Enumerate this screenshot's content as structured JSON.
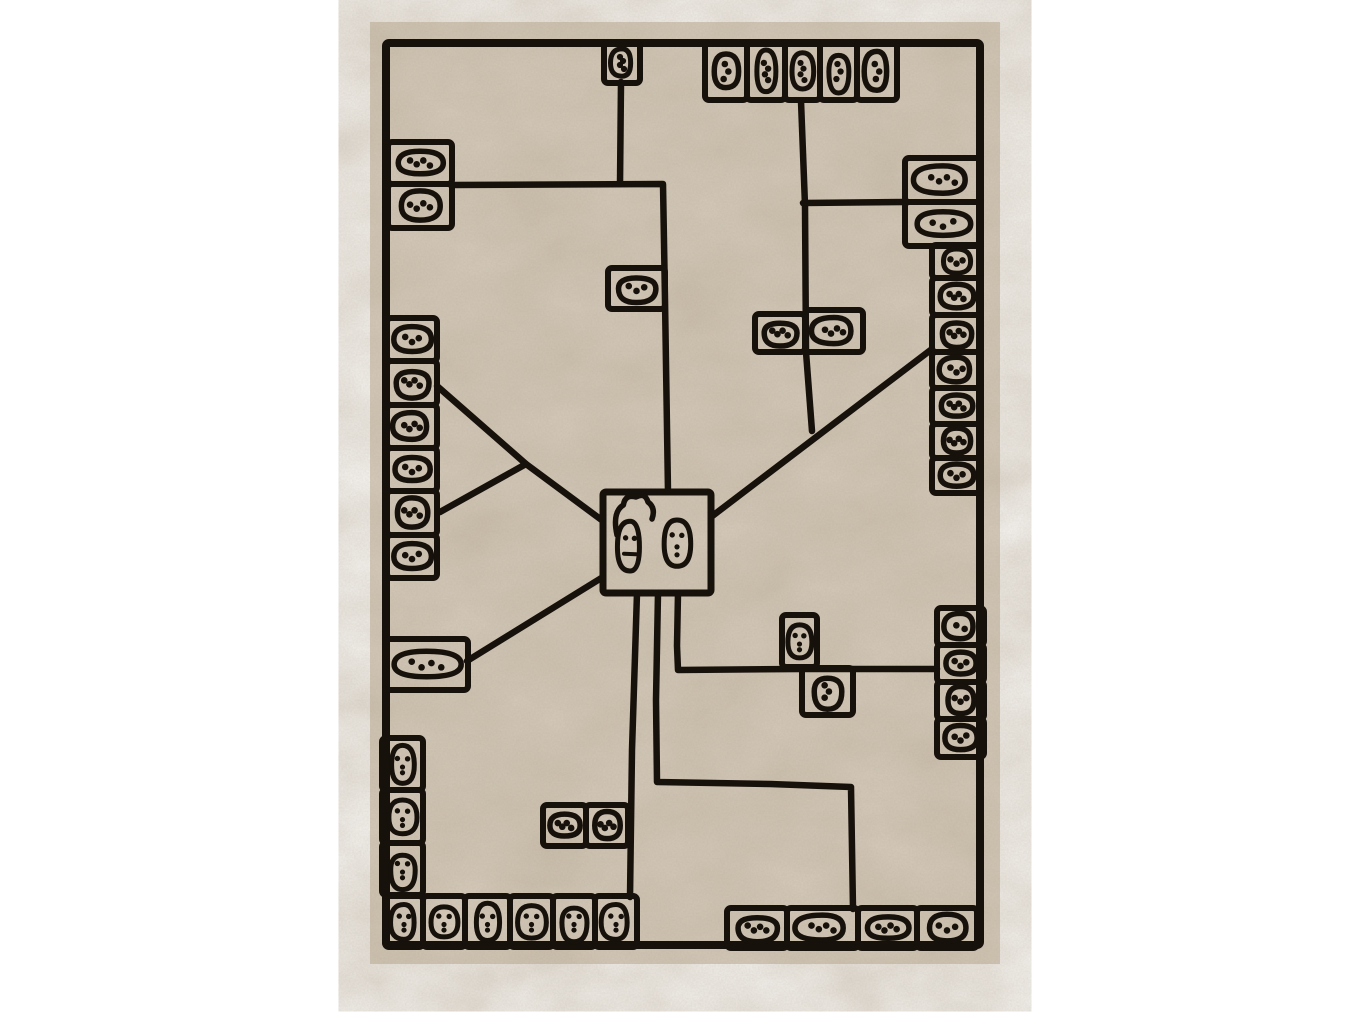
{
  "image": {
    "description": "Cream rectangular area rug with a black hand-drawn abstract line pattern of connected cells containing pebble and face motifs, photographed flat on a white background",
    "width": 1365,
    "height": 1023
  },
  "colors": {
    "page_bg": "#ffffff",
    "rug_base": "#dbd1c3",
    "rug_mottle": "#b3a48e",
    "rug_grain": "#9c8d78",
    "ink": "#17110b"
  },
  "rug": {
    "x": 370,
    "y": 22,
    "width": 630,
    "height": 942
  },
  "border": {
    "x": 386,
    "y": 43,
    "width": 594,
    "height": 902
  },
  "lines": [
    {
      "name": "top-cell-stem",
      "pts": [
        [
          621,
          82
        ],
        [
          620,
          184
        ]
      ]
    },
    {
      "name": "upper-middle-elbow",
      "pts": [
        [
          452,
          185
        ],
        [
          663,
          184
        ],
        [
          665,
          300
        ],
        [
          668,
          492
        ]
      ]
    },
    {
      "name": "left-diagonal-upper",
      "pts": [
        [
          437,
          386
        ],
        [
          526,
          464
        ],
        [
          603,
          521
        ]
      ]
    },
    {
      "name": "left-diagonal-lower",
      "pts": [
        [
          440,
          512
        ],
        [
          526,
          464
        ]
      ]
    },
    {
      "name": "lower-left-diagonal",
      "pts": [
        [
          467,
          661
        ],
        [
          603,
          577
        ]
      ]
    },
    {
      "name": "right-diagonal",
      "pts": [
        [
          711,
          517
        ],
        [
          932,
          349
        ]
      ]
    },
    {
      "name": "upper-right-vertical",
      "pts": [
        [
          801,
          101
        ],
        [
          805,
          205
        ],
        [
          806,
          352
        ],
        [
          812,
          431
        ]
      ]
    },
    {
      "name": "upper-right-branch",
      "pts": [
        [
          803,
          203
        ],
        [
          905,
          202
        ]
      ]
    },
    {
      "name": "center-stem-left",
      "pts": [
        [
          637,
          593
        ],
        [
          632,
          750
        ],
        [
          630,
          897
        ]
      ]
    },
    {
      "name": "center-stem-middle",
      "pts": [
        [
          658,
          593
        ],
        [
          656,
          700
        ],
        [
          657,
          782
        ],
        [
          770,
          784
        ],
        [
          851,
          787
        ],
        [
          853,
          909
        ]
      ]
    },
    {
      "name": "center-stem-right",
      "pts": [
        [
          678,
          593
        ],
        [
          677,
          646
        ],
        [
          678,
          670
        ],
        [
          800,
          669
        ],
        [
          937,
          669
        ]
      ]
    }
  ],
  "cell_groups": [
    {
      "name": "top-left-cell",
      "cells": [
        [
          604,
          43,
          36,
          40,
          "pv",
          4
        ]
      ]
    },
    {
      "name": "top-row",
      "cells": [
        [
          705,
          43,
          42,
          57,
          "pv",
          3
        ],
        [
          747,
          43,
          38,
          57,
          "pv",
          4
        ],
        [
          785,
          43,
          35,
          57,
          "pv",
          4
        ],
        [
          820,
          43,
          37,
          57,
          "pv",
          3
        ],
        [
          857,
          43,
          40,
          57,
          "pv",
          3
        ]
      ]
    },
    {
      "name": "left-upper-pair",
      "cells": [
        [
          388,
          142,
          64,
          42,
          "ph",
          4
        ],
        [
          388,
          184,
          64,
          44,
          "ph",
          4
        ]
      ]
    },
    {
      "name": "left-middle-column",
      "cells": [
        [
          387,
          318,
          50,
          43,
          "ph",
          3
        ],
        [
          387,
          361,
          50,
          44,
          "ph",
          4
        ],
        [
          387,
          405,
          50,
          43,
          "ph",
          4
        ],
        [
          387,
          448,
          50,
          43,
          "ph",
          3
        ],
        [
          387,
          491,
          50,
          44,
          "ph",
          4
        ],
        [
          387,
          535,
          50,
          43,
          "ph",
          3
        ]
      ]
    },
    {
      "name": "mid-left-cell",
      "cells": [
        [
          608,
          268,
          57,
          41,
          "ph",
          3
        ]
      ]
    },
    {
      "name": "right-wide-pair",
      "cells": [
        [
          905,
          158,
          76,
          44,
          "ph",
          4
        ],
        [
          905,
          202,
          76,
          44,
          "ph",
          3
        ]
      ]
    },
    {
      "name": "right-upper-column",
      "cells": [
        [
          932,
          245,
          49,
          33,
          "ps",
          3
        ],
        [
          932,
          278,
          49,
          37,
          "ps",
          4
        ],
        [
          932,
          315,
          49,
          37,
          "ps",
          4
        ],
        [
          932,
          352,
          49,
          36,
          "ps",
          3
        ],
        [
          932,
          388,
          49,
          36,
          "ps",
          4
        ],
        [
          932,
          424,
          49,
          34,
          "ps",
          4
        ],
        [
          932,
          458,
          49,
          35,
          "ps",
          3
        ]
      ]
    },
    {
      "name": "mid-right-pair",
      "cells": [
        [
          755,
          314,
          50,
          38,
          "ph",
          4
        ],
        [
          805,
          310,
          58,
          42,
          "ph",
          4
        ]
      ]
    },
    {
      "name": "left-long-cell",
      "cells": [
        [
          385,
          639,
          83,
          51,
          "pl",
          4
        ]
      ]
    },
    {
      "name": "left-lower-column",
      "cells": [
        [
          382,
          738,
          41,
          52,
          "fv",
          0
        ],
        [
          382,
          790,
          41,
          53,
          "fv",
          0
        ],
        [
          382,
          843,
          41,
          52,
          "fv",
          0
        ]
      ]
    },
    {
      "name": "bottom-left-row",
      "cells": [
        [
          385,
          896,
          38,
          51,
          "fv",
          0
        ],
        [
          423,
          896,
          42,
          51,
          "fv",
          0
        ],
        [
          465,
          896,
          45,
          51,
          "fv",
          0
        ],
        [
          510,
          896,
          43,
          51,
          "fv",
          0
        ],
        [
          553,
          896,
          42,
          51,
          "fv",
          0
        ],
        [
          595,
          896,
          42,
          51,
          "fv",
          0
        ]
      ]
    },
    {
      "name": "bottom-mid-pair",
      "cells": [
        [
          543,
          805,
          43,
          41,
          "ph",
          4
        ],
        [
          586,
          805,
          42,
          41,
          "ph",
          4
        ]
      ]
    },
    {
      "name": "mid-face-cell",
      "cells": [
        [
          782,
          615,
          35,
          52,
          "fv",
          0
        ]
      ]
    },
    {
      "name": "mid-pebble-cell",
      "cells": [
        [
          802,
          668,
          51,
          47,
          "pv",
          3
        ]
      ]
    },
    {
      "name": "right-lower-column",
      "cells": [
        [
          937,
          608,
          47,
          37,
          "ps",
          2
        ],
        [
          937,
          645,
          47,
          37,
          "ps",
          3
        ],
        [
          937,
          682,
          47,
          37,
          "ps",
          3
        ],
        [
          937,
          719,
          47,
          38,
          "ps",
          3
        ]
      ]
    },
    {
      "name": "bottom-right-row",
      "cells": [
        [
          727,
          908,
          60,
          40,
          "ph",
          4
        ],
        [
          787,
          908,
          71,
          40,
          "ph",
          4
        ],
        [
          858,
          908,
          59,
          40,
          "ph",
          4
        ],
        [
          917,
          908,
          60,
          40,
          "ph",
          3
        ]
      ]
    }
  ],
  "center_box": {
    "x": 603,
    "y": 492,
    "width": 108,
    "height": 101,
    "faces": [
      {
        "cx": 630,
        "cy": 547,
        "rx": 11,
        "ry": 24,
        "hair": true
      },
      {
        "cx": 677,
        "cy": 544,
        "rx": 12,
        "ry": 24,
        "hair": false
      }
    ]
  }
}
